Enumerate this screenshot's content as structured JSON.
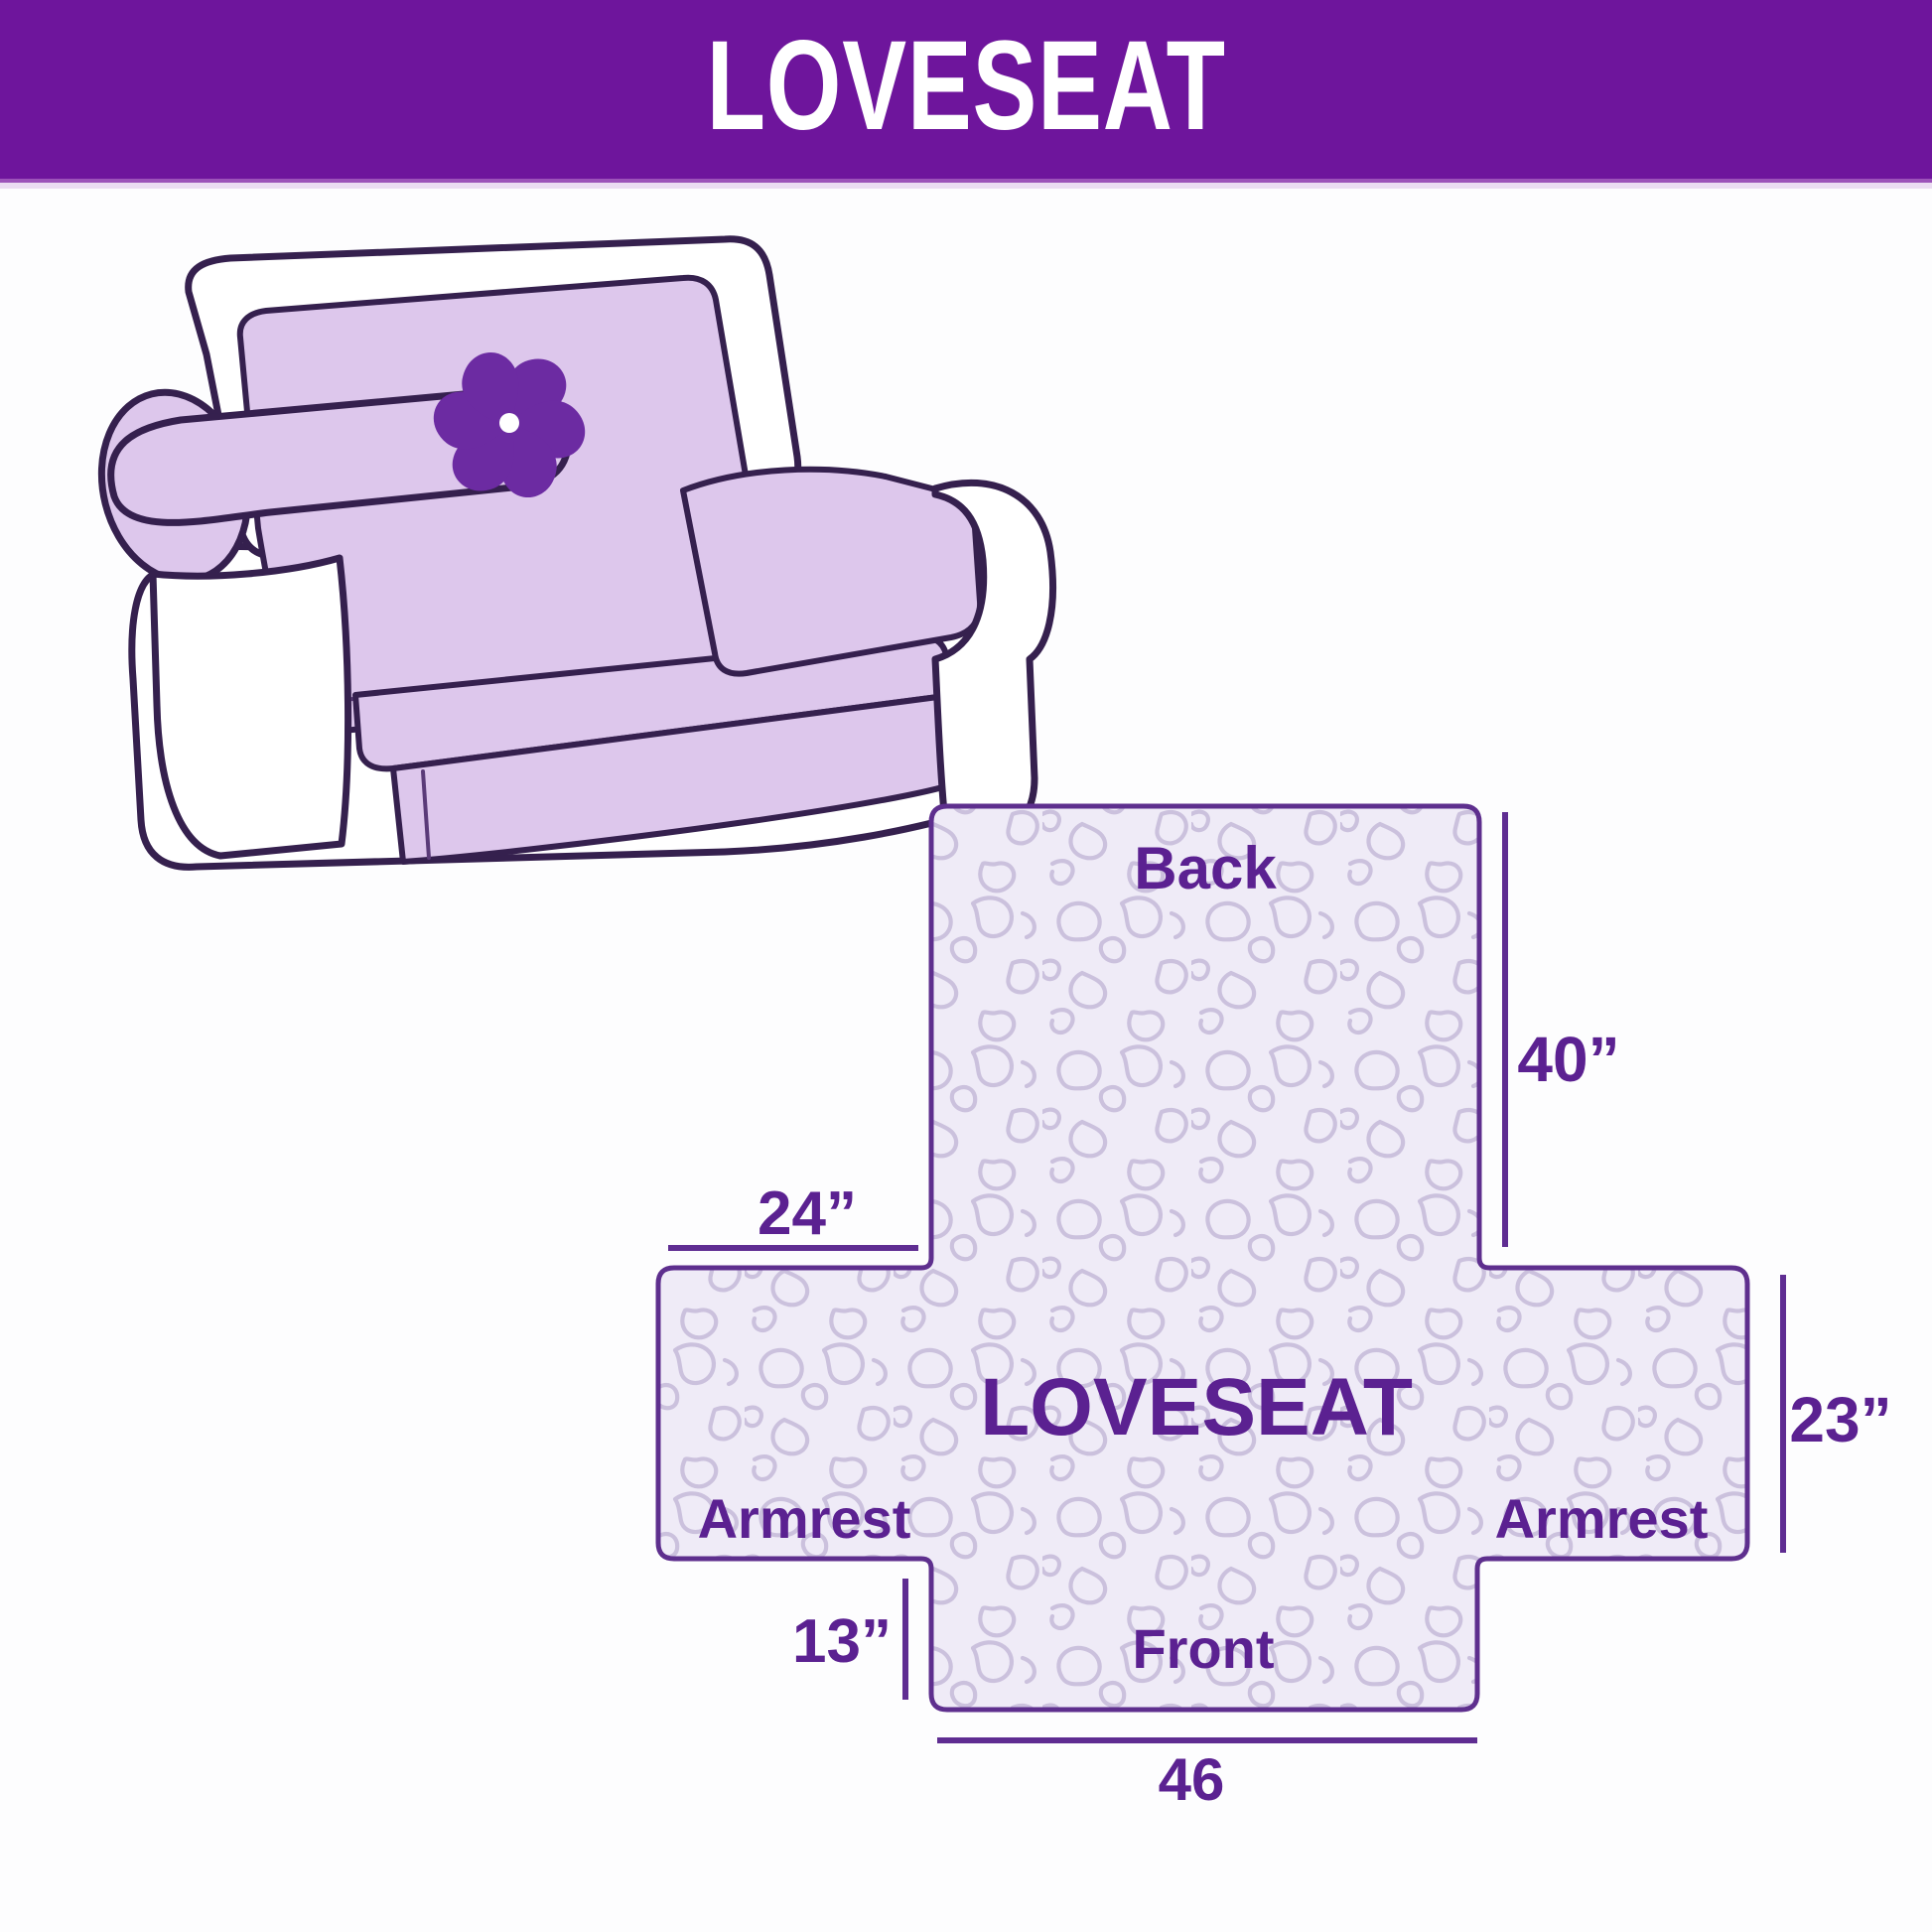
{
  "header": {
    "title": "LOVESEAT"
  },
  "illustration": {
    "description": "loveseat sofa with slipcover",
    "logo_icon": "pinwheel",
    "colors": {
      "cover_lavender": "#DDC7EC",
      "outline_dark_purple": "#35204E",
      "pinwheel_purple": "#6C2BA2",
      "body_white": "#FFFFFF"
    }
  },
  "diagram": {
    "center_label": "LOVESEAT",
    "sections": {
      "back": "Back",
      "front": "Front",
      "armrest_left": "Armrest",
      "armrest_right": "Armrest"
    },
    "dimensions": {
      "back_height": "40”",
      "armrest_flap_width": "24”",
      "seat_band_depth": "23”",
      "front_flap_height": "13”",
      "front_width": "46"
    },
    "colors": {
      "header_purple": "#6E159C",
      "label_purple": "#5B2191",
      "border_purple": "#5E2F8E",
      "quilt_fill": "#EFEBF7",
      "quilt_stitch": "#CBC1DD"
    }
  }
}
